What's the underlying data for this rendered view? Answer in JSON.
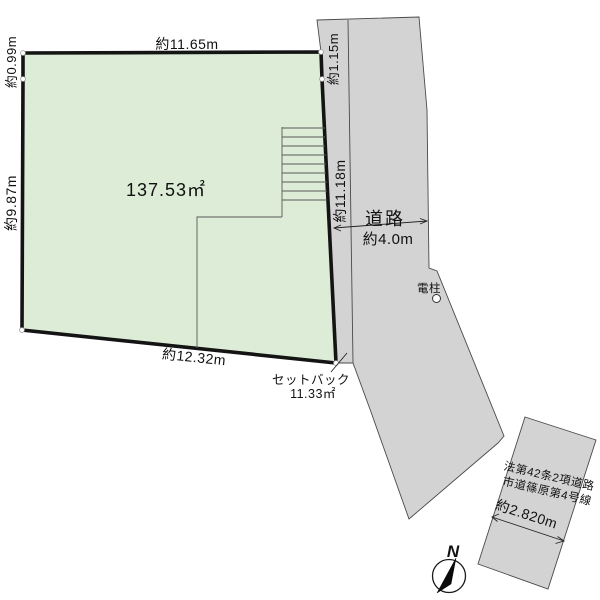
{
  "plot": {
    "area_label": "137.53㎡",
    "dim_top": "約11.65m",
    "dim_left_upper": "約0.99m",
    "dim_left": "約9.87m",
    "dim_right_upper": "約1.15m",
    "dim_right": "約11.18m",
    "dim_bottom": "約12.32m"
  },
  "road": {
    "label": "道路",
    "width": "約4.0m"
  },
  "setback": {
    "label": "セットバック",
    "area": "11.33㎡"
  },
  "utility_pole": {
    "label": "電柱"
  },
  "branch_road": {
    "law_ref": "法第42条2項道路",
    "road_name": "市道篠原第4号線",
    "width": "約2.820m"
  },
  "compass": {
    "north_label": "N"
  },
  "colors": {
    "plot_fill": "#dcecd6",
    "road_fill": "#d3d3d4",
    "plot_border": "#141414",
    "thin_line": "#4a4a4a",
    "dim_line": "#222222"
  }
}
